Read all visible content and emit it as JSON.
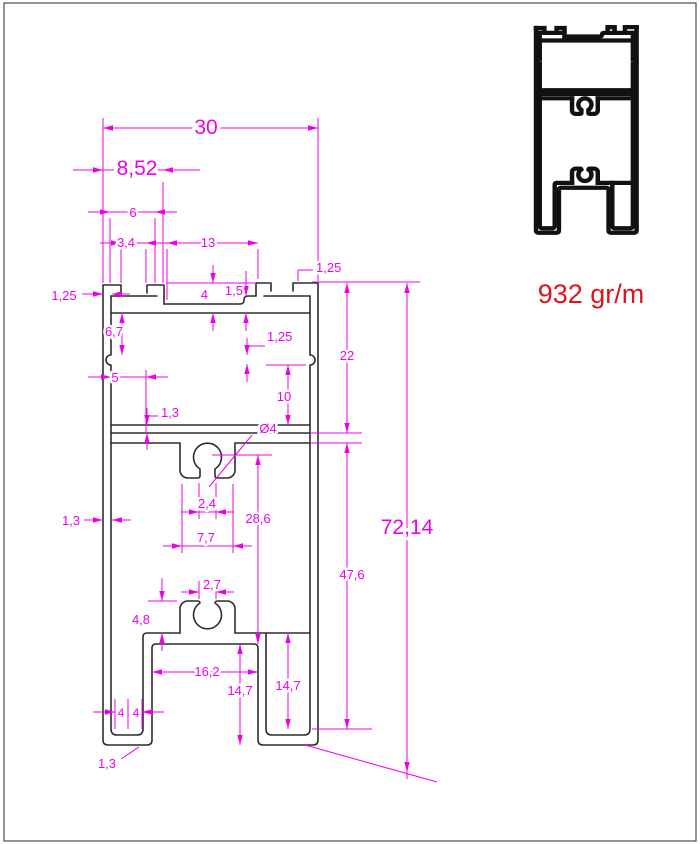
{
  "drawing": {
    "type": "technical-profile-cross-section",
    "units": "mm",
    "weight": {
      "text": "932 gr/m"
    },
    "colors": {
      "dimension": "#ee00ee",
      "outline": "#2d2d2d",
      "weight": "#dc1420",
      "border": "#4d4d4d"
    },
    "dimension_values": [
      "30",
      "8,52",
      "6",
      "3,4",
      "13",
      "1,25",
      "4",
      "1,5",
      "1,25",
      "6,7",
      "5",
      "1,25",
      "10",
      "22",
      "1,3",
      "Ø4",
      "2,4",
      "7,7",
      "28,6",
      "47,6",
      "72,14",
      "2,7",
      "4,8",
      "16,2",
      "14,7",
      "14,7",
      "4",
      "4",
      "1,3",
      "1,3"
    ],
    "dimensions": [
      {
        "name": "width-30",
        "label": "30",
        "fs": 21,
        "lx": 206,
        "ly": 134,
        "lines": [
          [
            103,
            128,
            318,
            128
          ],
          [
            103,
            118,
            103,
            283
          ],
          [
            318,
            118,
            318,
            281
          ]
        ],
        "arrows": [
          [
            103,
            128,
            "l"
          ],
          [
            318,
            128,
            "r"
          ]
        ]
      },
      {
        "name": "width-8-52",
        "label": "8,52",
        "fs": 21,
        "lx": 137,
        "ly": 175,
        "lines": [
          [
            73,
            170,
            200,
            170
          ],
          [
            163,
            182,
            163,
            283
          ]
        ],
        "arrows": [
          [
            103,
            170,
            "r"
          ],
          [
            163,
            170,
            "l"
          ]
        ]
      },
      {
        "name": "width-6",
        "label": "6",
        "fs": 13,
        "lx": 133,
        "ly": 217,
        "lines": [
          [
            88,
            212,
            177,
            212
          ],
          [
            110,
            218,
            110,
            283
          ],
          [
            155,
            218,
            155,
            283
          ]
        ],
        "arrows": [
          [
            110,
            212,
            "r"
          ],
          [
            155,
            212,
            "l"
          ]
        ]
      },
      {
        "name": "width-3-4",
        "label": "3,4",
        "fs": 13,
        "lx": 126,
        "ly": 247,
        "lines": [
          [
            100,
            243,
            168,
            243
          ],
          [
            121,
            249,
            121,
            283
          ],
          [
            146,
            249,
            146,
            283
          ]
        ],
        "arrows": [
          [
            121,
            243,
            "r"
          ],
          [
            146,
            243,
            "l"
          ]
        ]
      },
      {
        "name": "width-13",
        "label": "13",
        "fs": 13,
        "lx": 208,
        "ly": 247,
        "lines": [
          [
            167,
            243,
            258,
            243
          ],
          [
            167,
            249,
            167,
            300
          ],
          [
            258,
            249,
            258,
            279
          ]
        ],
        "arrows": [
          [
            167,
            243,
            "l"
          ],
          [
            258,
            243,
            "r"
          ]
        ]
      },
      {
        "name": "lip-1-25-top-right",
        "label": "1,25",
        "fs": 13,
        "lx": 316,
        "ly": 272,
        "anchor": "start",
        "lines": [
          [
            298,
            270,
            298,
            281
          ],
          [
            298,
            270,
            313,
            270
          ]
        ],
        "arrows": []
      },
      {
        "name": "depth-4",
        "label": "4",
        "fs": 13,
        "lx": 208,
        "ly": 299,
        "anchor": "end",
        "lines": [
          [
            167,
            283,
            256,
            283
          ],
          [
            213,
            265,
            213,
            283
          ],
          [
            213,
            313,
            213,
            331
          ]
        ],
        "arrows": [
          [
            213,
            283,
            "d"
          ],
          [
            213,
            313,
            "u"
          ]
        ]
      },
      {
        "name": "step-1-5",
        "label": "1,5",
        "fs": 13,
        "lx": 243,
        "ly": 295,
        "anchor": "end",
        "lines": [
          [
            246,
            271,
            246,
            296
          ],
          [
            246,
            313,
            246,
            331
          ]
        ],
        "arrows": [
          [
            246,
            296,
            "d"
          ],
          [
            246,
            313,
            "u"
          ]
        ]
      },
      {
        "name": "lip-1-25-top-left",
        "label": "1,25",
        "fs": 13,
        "lx": 64,
        "ly": 300,
        "lines": [
          [
            82,
            294,
            103,
            294
          ],
          [
            112,
            294,
            130,
            294
          ]
        ],
        "arrows": [
          [
            103,
            294,
            "r"
          ],
          [
            112,
            294,
            "l"
          ]
        ]
      },
      {
        "name": "height-6-7",
        "label": "6,7",
        "fs": 13,
        "lx": 114,
        "ly": 336,
        "lines": [
          [
            122,
            313,
            122,
            355
          ]
        ],
        "arrows": [
          [
            122,
            313,
            "u"
          ],
          [
            122,
            355,
            "d"
          ]
        ]
      },
      {
        "name": "width-5",
        "label": "5",
        "fs": 13,
        "lx": 115,
        "ly": 382,
        "lines": [
          [
            88,
            377,
            168,
            377
          ],
          [
            146,
            370,
            146,
            433
          ]
        ],
        "arrows": [
          [
            111,
            377,
            "r"
          ],
          [
            146,
            377,
            "l"
          ]
        ]
      },
      {
        "name": "notch-1-25-right",
        "label": "1,25",
        "fs": 13,
        "lx": 267,
        "ly": 341,
        "anchor": "start",
        "lines": [
          [
            247,
            346,
            265,
            346
          ],
          [
            247,
            338,
            247,
            355
          ],
          [
            247,
            364,
            247,
            382
          ]
        ],
        "arrows": [
          [
            247,
            355,
            "d"
          ],
          [
            247,
            364,
            "u"
          ]
        ]
      },
      {
        "name": "height-10",
        "label": "10",
        "fs": 13,
        "lx": 284,
        "ly": 401,
        "lines": [
          [
            288,
            365,
            288,
            425
          ],
          [
            266,
            365,
            306,
            365
          ]
        ],
        "arrows": [
          [
            288,
            365,
            "u"
          ],
          [
            288,
            425,
            "d"
          ]
        ]
      },
      {
        "name": "height-22",
        "label": "22",
        "fs": 13,
        "lx": 347,
        "ly": 360,
        "lines": [
          [
            347,
            283,
            347,
            433
          ],
          [
            312,
            282,
            420,
            282
          ],
          [
            310,
            433,
            362,
            433
          ],
          [
            310,
            443,
            362,
            443
          ]
        ],
        "arrows": [
          [
            347,
            283,
            "u"
          ],
          [
            347,
            433,
            "d"
          ]
        ]
      },
      {
        "name": "wall-1-3-divider",
        "label": "1,3",
        "fs": 13,
        "lx": 170,
        "ly": 417,
        "lines": [
          [
            147,
            416,
            158,
            416
          ],
          [
            147,
            408,
            147,
            425
          ],
          [
            147,
            433,
            147,
            450
          ]
        ],
        "arrows": [
          [
            147,
            425,
            "d"
          ],
          [
            147,
            433,
            "u"
          ]
        ]
      },
      {
        "name": "hole-diameter-4",
        "label": "Ø4",
        "fs": 13,
        "lx": 268,
        "ly": 433,
        "lines": [
          [
            252,
            435,
            209,
            487
          ]
        ],
        "arrows": []
      },
      {
        "name": "slot-2-4",
        "label": "2,4",
        "fs": 13,
        "lx": 207,
        "ly": 508,
        "lines": [
          [
            181,
            512,
            234,
            512
          ],
          [
            199,
            483,
            199,
            519
          ],
          [
            216,
            483,
            216,
            519
          ]
        ],
        "arrows": [
          [
            199,
            512,
            "r"
          ],
          [
            216,
            512,
            "l"
          ]
        ]
      },
      {
        "name": "width-7-7",
        "label": "7,7",
        "fs": 13,
        "lx": 206,
        "ly": 542,
        "lines": [
          [
            163,
            546,
            252,
            546
          ],
          [
            182,
            484,
            182,
            553
          ],
          [
            233,
            484,
            233,
            553
          ]
        ],
        "arrows": [
          [
            182,
            546,
            "r"
          ],
          [
            233,
            546,
            "l"
          ]
        ]
      },
      {
        "name": "height-28-6",
        "label": "28,6",
        "fs": 13,
        "lx": 258,
        "ly": 523,
        "lines": [
          [
            258,
            455,
            258,
            644
          ],
          [
            212,
            455,
            272,
            455
          ]
        ],
        "arrows": [
          [
            258,
            455,
            "u"
          ],
          [
            258,
            644,
            "d"
          ]
        ]
      },
      {
        "name": "height-47-6",
        "label": "47,6",
        "fs": 13,
        "lx": 352,
        "ly": 579,
        "lines": [
          [
            347,
            443,
            347,
            729
          ],
          [
            312,
            729,
            372,
            729
          ]
        ],
        "arrows": [
          [
            347,
            443,
            "u"
          ],
          [
            347,
            729,
            "d"
          ]
        ]
      },
      {
        "name": "height-72-14",
        "label": "72,14",
        "fs": 21,
        "lx": 407,
        "ly": 534,
        "lines": [
          [
            407,
            283,
            407,
            779
          ],
          [
            305,
            745,
            437,
            782
          ]
        ],
        "arrows": [
          [
            407,
            283,
            "u"
          ],
          [
            407,
            772,
            "d"
          ]
        ]
      },
      {
        "name": "slot-2-7",
        "label": "2,7",
        "fs": 13,
        "lx": 212,
        "ly": 589,
        "lines": [
          [
            181,
            592,
            199,
            592
          ],
          [
            216,
            592,
            234,
            592
          ],
          [
            199,
            581,
            199,
            599
          ],
          [
            216,
            581,
            216,
            599
          ]
        ],
        "arrows": [
          [
            199,
            592,
            "r"
          ],
          [
            216,
            592,
            "l"
          ]
        ]
      },
      {
        "name": "height-4-8",
        "label": "4,8",
        "fs": 13,
        "lx": 141,
        "ly": 624,
        "lines": [
          [
            162,
            578,
            162,
            601
          ],
          [
            162,
            633,
            162,
            651
          ],
          [
            148,
            601,
            177,
            601
          ]
        ],
        "arrows": [
          [
            162,
            601,
            "d"
          ],
          [
            162,
            633,
            "u"
          ]
        ]
      },
      {
        "name": "width-16-2",
        "label": "16,2",
        "fs": 13,
        "lx": 207,
        "ly": 676,
        "lines": [
          [
            152,
            672,
            258,
            672
          ]
        ],
        "arrows": [
          [
            152,
            672,
            "l"
          ],
          [
            258,
            672,
            "r"
          ]
        ]
      },
      {
        "name": "height-14-7-left",
        "label": "14,7",
        "fs": 13,
        "lx": 240,
        "ly": 695,
        "lines": [
          [
            240,
            644,
            240,
            745
          ]
        ],
        "arrows": [
          [
            240,
            644,
            "u"
          ],
          [
            240,
            745,
            "d"
          ]
        ]
      },
      {
        "name": "height-14-7-right",
        "label": "14,7",
        "fs": 13,
        "lx": 288,
        "ly": 690,
        "lines": [
          [
            288,
            633,
            288,
            729
          ]
        ],
        "arrows": [
          [
            288,
            633,
            "u"
          ],
          [
            288,
            729,
            "d"
          ]
        ]
      },
      {
        "name": "feet-4-4",
        "fs": 12,
        "labels": [
          {
            "text": "4",
            "x": 121,
            "y": 717
          },
          {
            "text": "4",
            "x": 136,
            "y": 717
          }
        ],
        "lines": [
          [
            93,
            712,
            115,
            712
          ],
          [
            142,
            712,
            164,
            712
          ],
          [
            115,
            699,
            115,
            729
          ],
          [
            128,
            699,
            128,
            729
          ],
          [
            142,
            699,
            142,
            729
          ]
        ],
        "arrows": [
          [
            115,
            712,
            "r"
          ],
          [
            142,
            712,
            "l"
          ]
        ]
      },
      {
        "name": "wall-1-3-bottom",
        "label": "1,3",
        "fs": 13,
        "lx": 107,
        "ly": 768,
        "lines": [
          [
            121,
            759,
            139,
            747
          ]
        ],
        "arrows": []
      },
      {
        "name": "wall-1-3-left",
        "label": "1,3",
        "fs": 13,
        "lx": 71,
        "ly": 525,
        "lines": [
          [
            84,
            520,
            103,
            520
          ],
          [
            112,
            520,
            131,
            520
          ]
        ],
        "arrows": [
          [
            103,
            520,
            "r"
          ],
          [
            112,
            520,
            "l"
          ]
        ]
      }
    ]
  }
}
